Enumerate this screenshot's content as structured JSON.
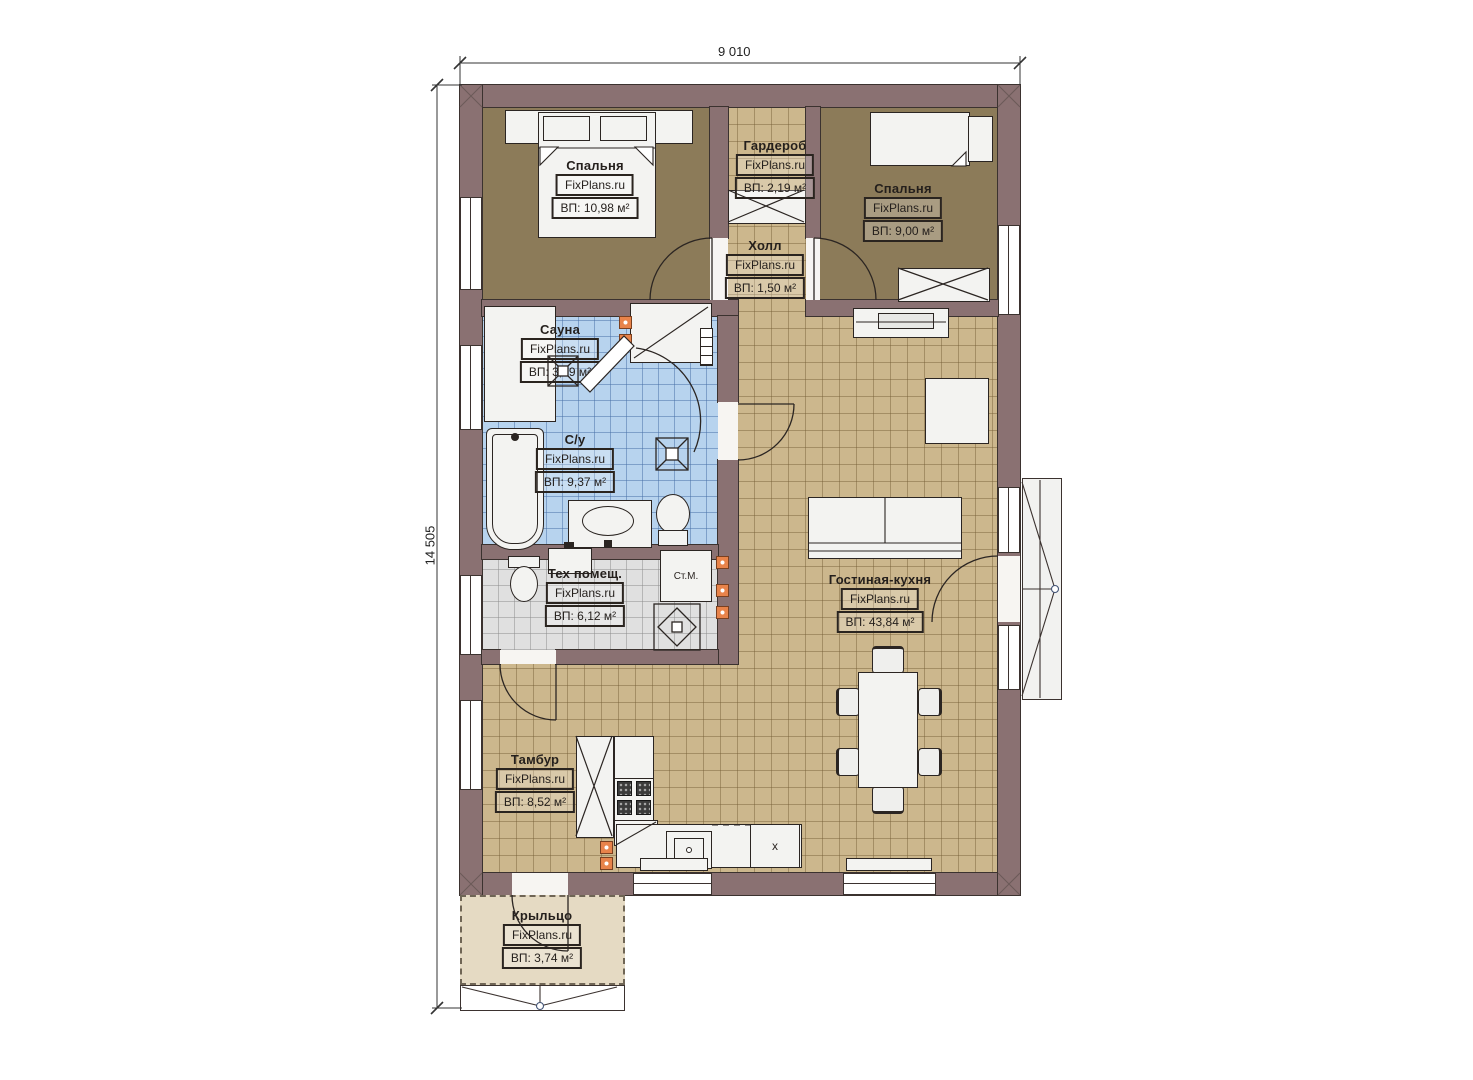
{
  "plan": {
    "dimension_top": "9 010",
    "dimension_left": "14 505",
    "watermark": "FixPlans.ru",
    "rooms": [
      {
        "name": "Спальня",
        "area": "ВП: 10,98 м²"
      },
      {
        "name": "Гардероб",
        "area": "ВП: 2,19 м²"
      },
      {
        "name": "Спальня",
        "area": "ВП: 9,00 м²"
      },
      {
        "name": "Холл",
        "area": "ВП: 1,50 м²"
      },
      {
        "name": "Сауна",
        "area": "ВП: 3,59 м²"
      },
      {
        "name": "С/у",
        "area": "ВП: 9,37 м²"
      },
      {
        "name": "Тех помещ.",
        "area": "ВП: 6,12 м²"
      },
      {
        "name": "Гостиная-кухня",
        "area": "ВП: 43,84 м²"
      },
      {
        "name": "Тамбур",
        "area": "ВП: 8,52 м²"
      },
      {
        "name": "Крыльцо",
        "area": "ВП: 3,74 м²"
      }
    ],
    "appliance_labels": {
      "washing_machine": "Ст.М.",
      "kitchen_cabinet": "x"
    },
    "colors": {
      "wall": "#8a7172",
      "tile_tan": "#ccb78d",
      "tile_blue": "#b7d3ee",
      "tile_gray": "#e0e0e0",
      "floor_bedroom": "#8c7b59",
      "porch": "#e5dac3",
      "vent": "#e8834a"
    }
  }
}
